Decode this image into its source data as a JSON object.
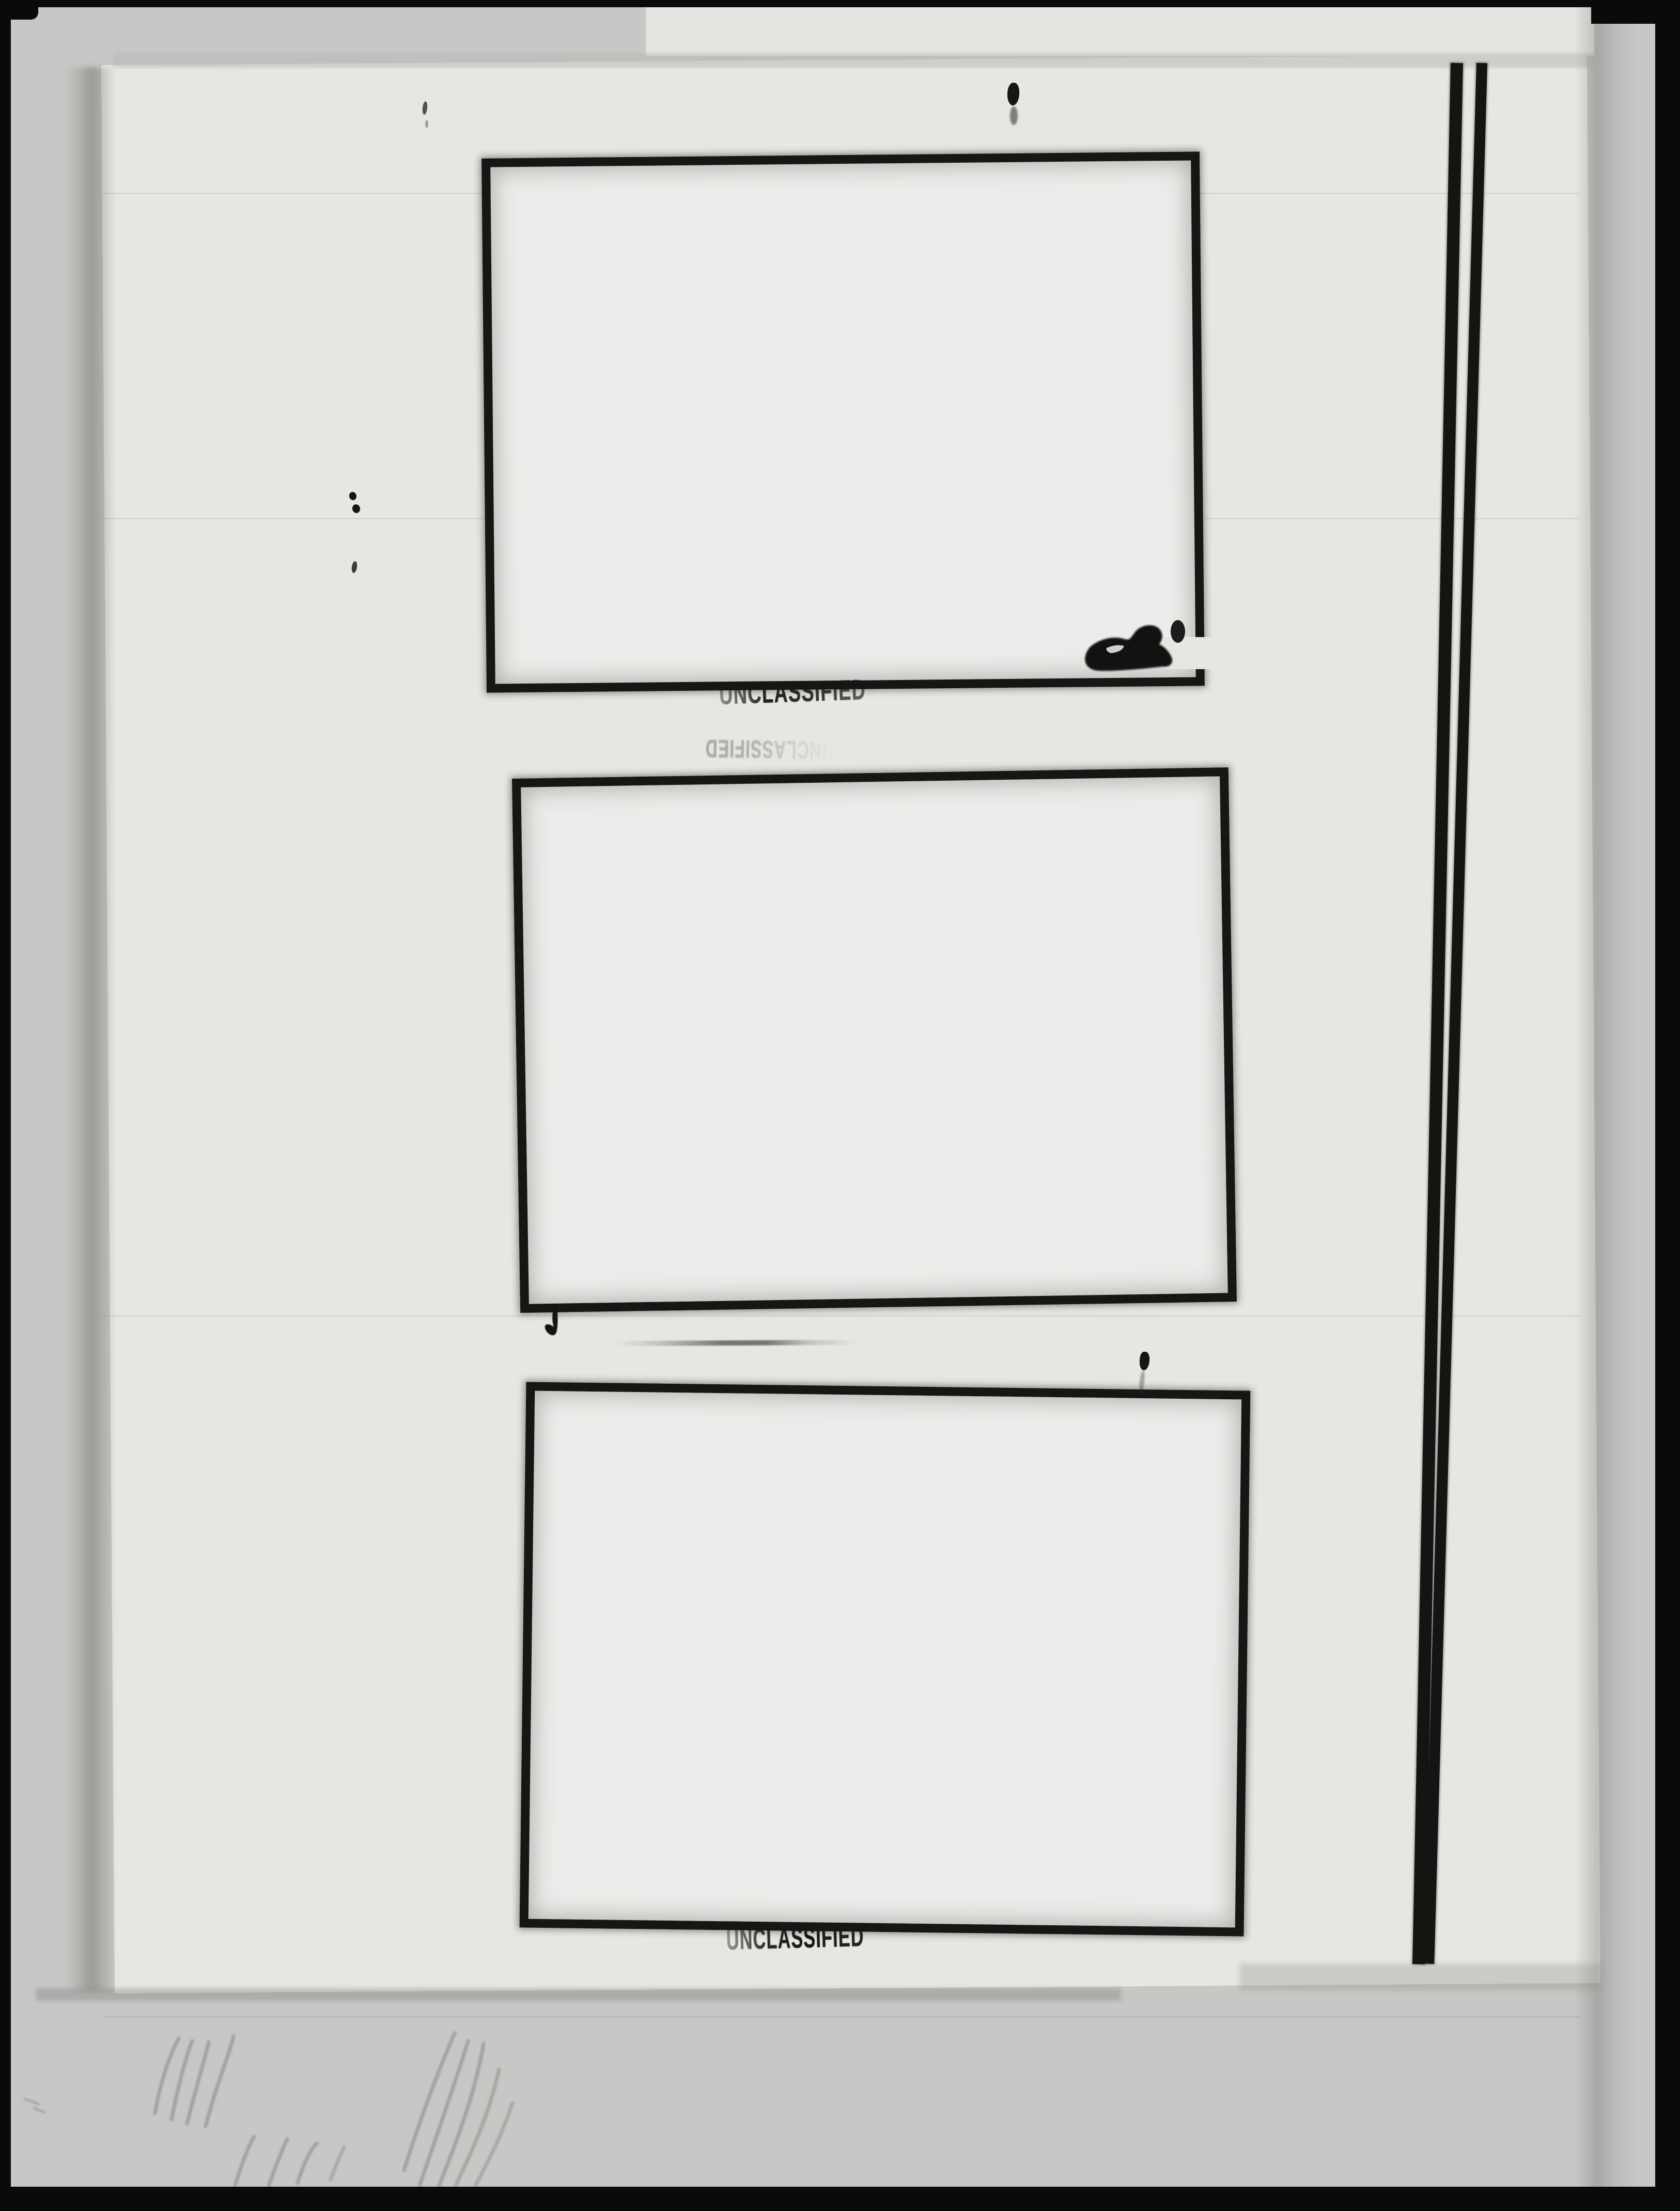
{
  "stamps": {
    "frame1_caption": "UNCLASSIFIED",
    "frame3_caption": "UNCLASSIFIED",
    "ghost_stamp": "UNCLASSIFIED"
  },
  "colors": {
    "film_black": "#0a0a0a",
    "outer_sheet": "#c8c7c5",
    "inner_page": "#e7e6e3",
    "frame_interior": "#edecea",
    "ink": "#161614"
  },
  "frames": [
    {
      "label": "empty photo frame 1"
    },
    {
      "label": "empty photo frame 2"
    },
    {
      "label": "empty photo frame 3"
    }
  ]
}
